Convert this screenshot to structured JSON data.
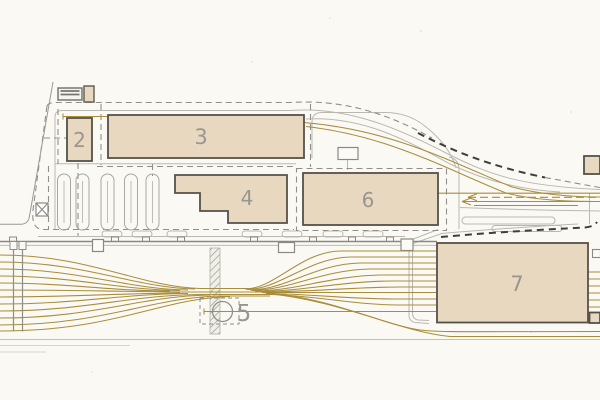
{
  "drawing": {
    "type": "railway-depot-site-plan",
    "labels": {
      "building2": "2",
      "building3": "3",
      "building4": "4",
      "structure5": "5",
      "building6": "6",
      "building7": "7"
    },
    "colors": {
      "paper": "#fbf9f3",
      "building_fill": "#e8d8bf",
      "building_border": "#55504a",
      "track": "#a88d3c",
      "track_faint": "#c2b172",
      "road": "#b9b9b2",
      "wall": "#8a8a85",
      "boundary_bold": "#3f3f3c",
      "boundary_light": "#90908a",
      "label_color": "#98968e"
    }
  }
}
